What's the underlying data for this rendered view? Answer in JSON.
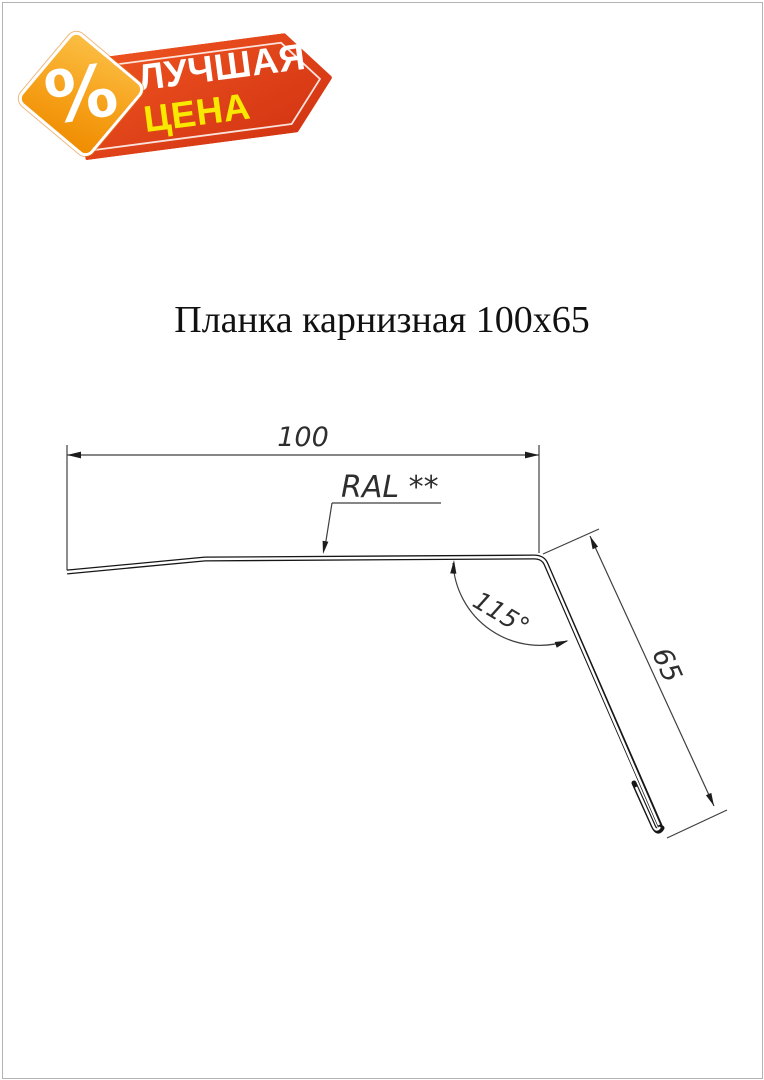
{
  "badge": {
    "line1": "ЛУЧШАЯ",
    "line2": "ЦЕНА",
    "percent_symbol": "%",
    "colors": {
      "banner_red_light": "#ee5320",
      "banner_red_dark": "#d23412",
      "line1_color": "#ffffff",
      "line2_color": "#f9e800",
      "diamond_orange_light": "#fbbf44",
      "diamond_orange_dark": "#ef8c00"
    }
  },
  "title": {
    "text": "Планка карнизная 100х65"
  },
  "drawing": {
    "width_dim_label": "100",
    "height_dim_label": "65",
    "angle_label": "115°",
    "color_note_label": "RAL **",
    "profile_line_color": "#161616",
    "dimension_line_color": "#3f3f3f"
  }
}
